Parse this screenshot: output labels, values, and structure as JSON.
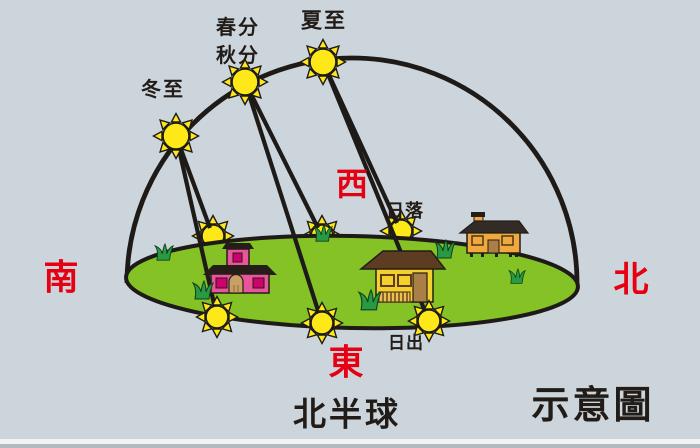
{
  "labels": {
    "winter_solstice": "冬至",
    "spring_equinox": "春分",
    "autumn_equinox": "秋分",
    "summer_solstice": "夏至",
    "sunset": "日落",
    "sunrise": "日出",
    "south": "南",
    "west": "西",
    "east": "東",
    "north": "北",
    "hemisphere": "北半球",
    "schematic": "示意圖"
  },
  "colors": {
    "sky": "#ccd5db",
    "ground": "#84c226",
    "sun_fill": "#ffe817",
    "outline": "#1d1a17",
    "direction_red": "#e60012",
    "text_dark": "#221c18",
    "house_pink": "#e8559b",
    "house_magenta": "#d0006e",
    "house_yellow": "#f3d02c",
    "roof_brown": "#5e3c22",
    "house_orange": "#f1a93e",
    "roof_dark": "#332c26",
    "door_tan": "#c9a063",
    "door_brown": "#aa7f47",
    "grass_green": "#279a43"
  },
  "scene": {
    "dome": {
      "cx": 352,
      "cy": 283,
      "r": 225,
      "stroke_width": 4.8
    },
    "ground": {
      "cx": 352,
      "cy": 282,
      "rx": 226,
      "ry": 46,
      "tilt_deg": 1.2,
      "stroke_width": 4
    },
    "line_width": 4.2,
    "sky_suns": [
      {
        "name": "sun-winter-solstice",
        "x": 176,
        "y": 136,
        "r": 13
      },
      {
        "name": "sun-equinox",
        "x": 245,
        "y": 82,
        "r": 13
      },
      {
        "name": "sun-summer-solstice",
        "x": 323,
        "y": 62,
        "r": 13
      }
    ],
    "sunset_suns": [
      {
        "name": "sun-sunset-winter",
        "x": 213,
        "y": 236,
        "r": 11
      },
      {
        "name": "sun-sunset-equinox",
        "x": 322,
        "y": 236,
        "r": 11
      },
      {
        "name": "sun-sunset-summer",
        "x": 401,
        "y": 231,
        "r": 11
      }
    ],
    "sunrise_suns": [
      {
        "name": "sun-sunrise-winter",
        "x": 217,
        "y": 317,
        "r": 11
      },
      {
        "name": "sun-sunrise-equinox",
        "x": 322,
        "y": 323,
        "r": 11
      },
      {
        "name": "sun-sunrise-summer",
        "x": 429,
        "y": 321,
        "r": 11
      }
    ],
    "sun_paths": [
      {
        "name": "path-winter-to-sunset",
        "x1": 176,
        "y1": 136,
        "x2": 210,
        "y2": 228
      },
      {
        "name": "path-winter-to-sunrise",
        "x1": 176,
        "y1": 136,
        "x2": 217,
        "y2": 317
      },
      {
        "name": "path-equinox-to-sunset",
        "x1": 245,
        "y1": 82,
        "x2": 318,
        "y2": 228
      },
      {
        "name": "path-equinox-to-sunrise",
        "x1": 245,
        "y1": 82,
        "x2": 322,
        "y2": 323
      },
      {
        "name": "path-summer-to-sunset",
        "x1": 323,
        "y1": 62,
        "x2": 397,
        "y2": 223
      },
      {
        "name": "path-summer-to-sunrise",
        "x1": 323,
        "y1": 62,
        "x2": 429,
        "y2": 321
      }
    ]
  }
}
